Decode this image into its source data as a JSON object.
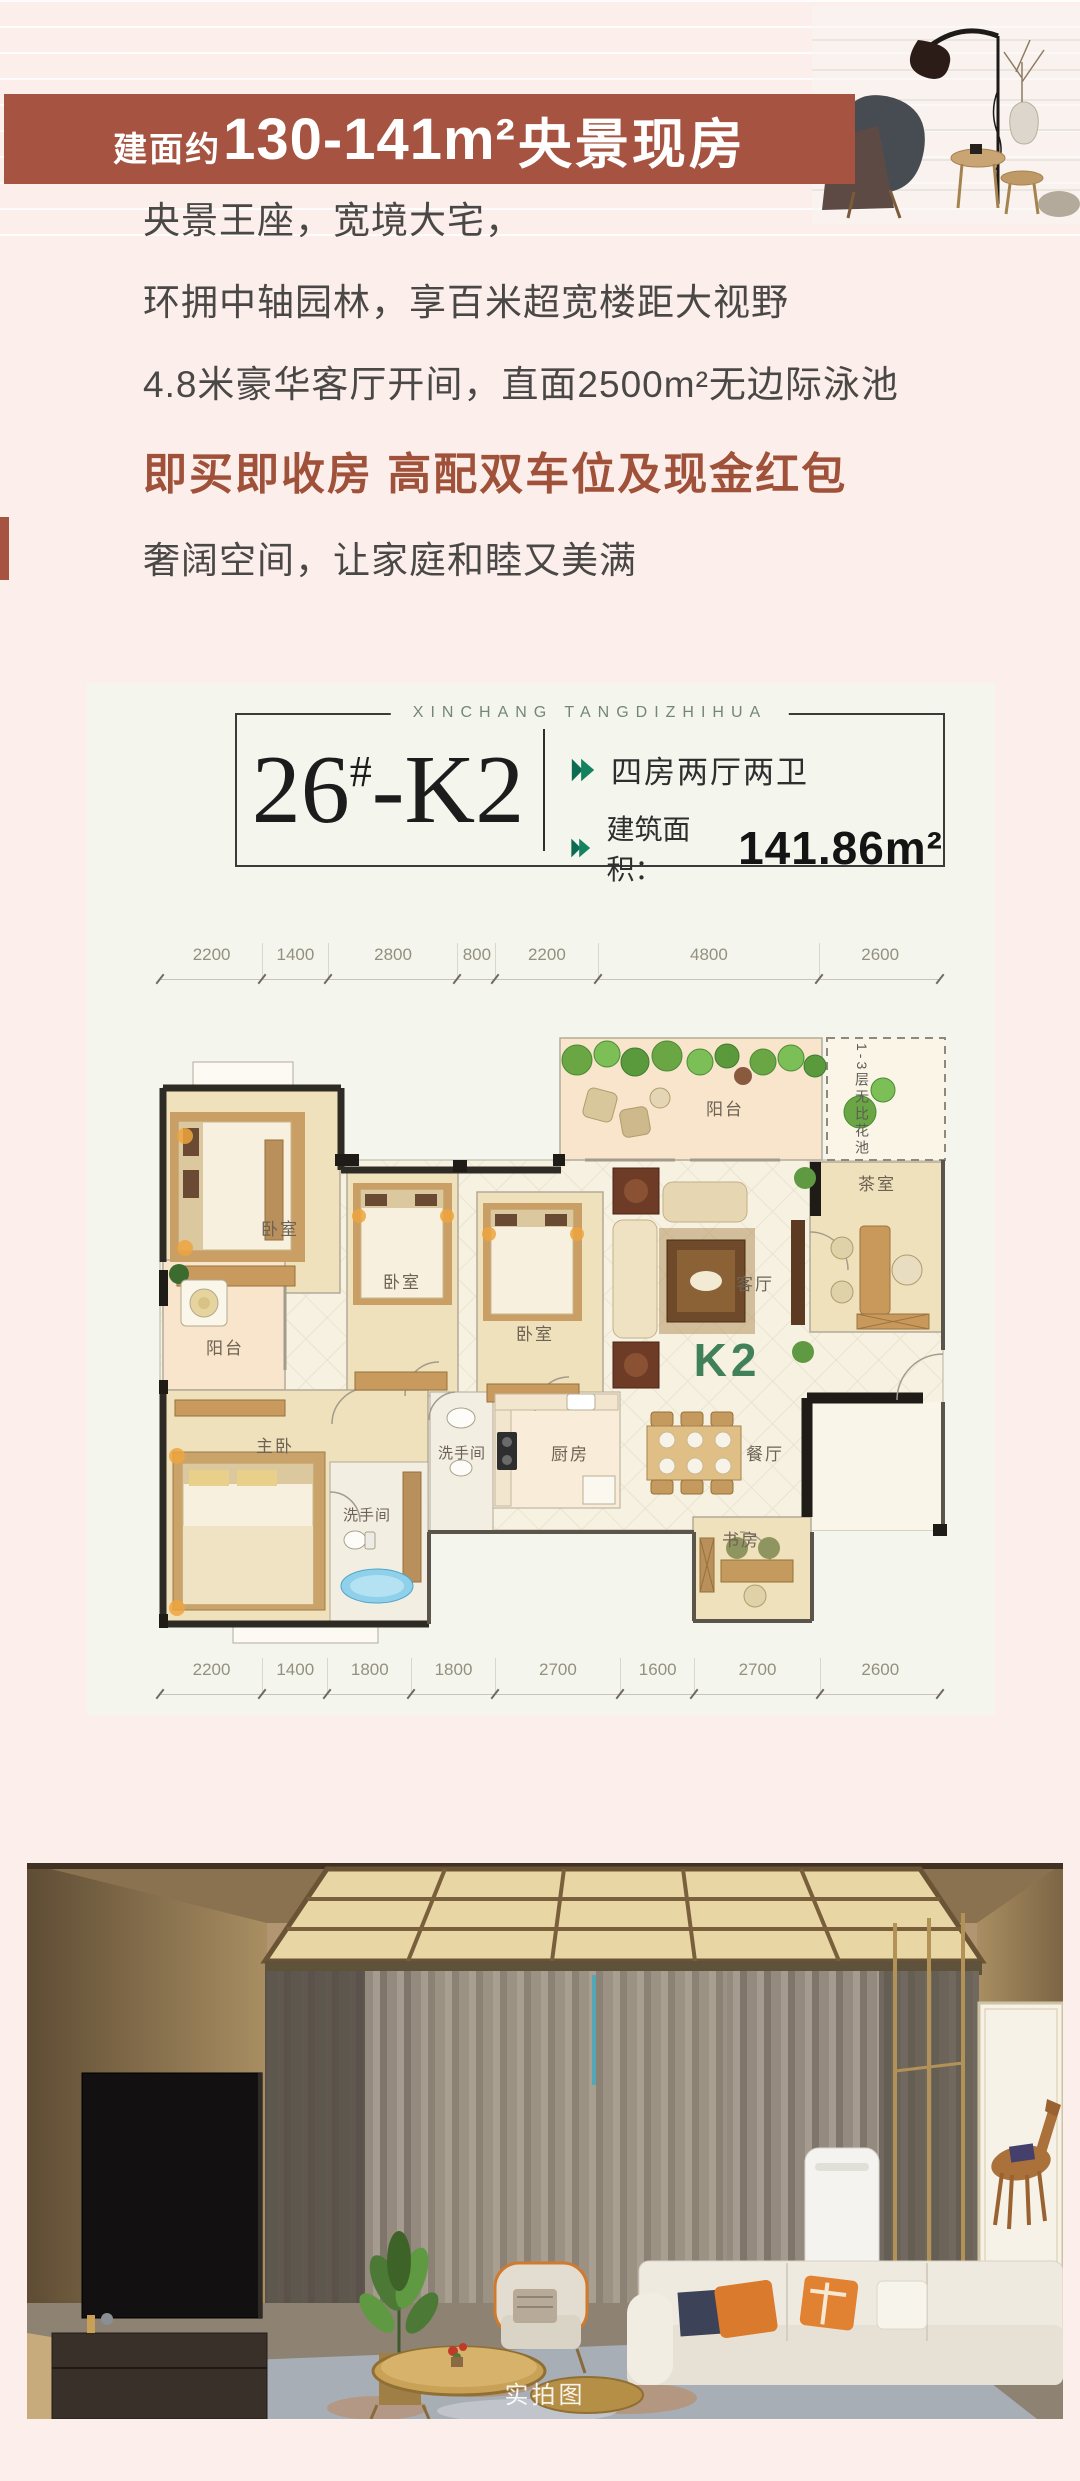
{
  "banner": {
    "prefix": "建面约",
    "range": "130-141m²",
    "suffix": "央景现房"
  },
  "intro": {
    "line1": "央景王座，宽境大宅，",
    "line2": "环拥中轴园林，享百米超宽楼距大视野",
    "line3": "4.8米豪华客厅开间，直面2500m²无边际泳池",
    "line4": "即买即收房 高配双车位及现金红包",
    "line5": "奢阔空间，让家庭和睦又美满"
  },
  "card": {
    "brand": "XINCHANG TANGDIZHIHUA",
    "unit_number": "26",
    "unit_hash": "#",
    "unit_rest": "-K2",
    "spec_rooms": "四房两厅两卫",
    "area_label": "建筑面积：",
    "area_value": "141.86m²"
  },
  "floor_plan": {
    "unit_label": "K2",
    "garden_note": "1-3层无比花池",
    "dims_top": [
      "2200",
      "1400",
      "2800",
      "800",
      "2200",
      "4800",
      "2600"
    ],
    "dims_bottom": [
      "2200",
      "1400",
      "1800",
      "1800",
      "2700",
      "1600",
      "2700",
      "2600"
    ],
    "rooms": {
      "bedroom1": "卧室",
      "bedroom2": "卧室",
      "bedroom3": "卧室",
      "master": "主卧",
      "balcony_top": "阳台",
      "balcony_left": "阳台",
      "living": "客厅",
      "tea": "茶室",
      "dining": "餐厅",
      "kitchen": "厨房",
      "bath1": "洗手间",
      "bath2": "洗手间",
      "study": "书房"
    }
  },
  "photo": {
    "watermark": "实拍图"
  },
  "colors": {
    "banner_brown": "#a65441",
    "accent_text_brown": "#a0513a",
    "page_pink": "#fcefeb",
    "card_bg": "#f4f6ee",
    "arrow_green": "#0d6b52",
    "k2_green": "#40815a"
  }
}
